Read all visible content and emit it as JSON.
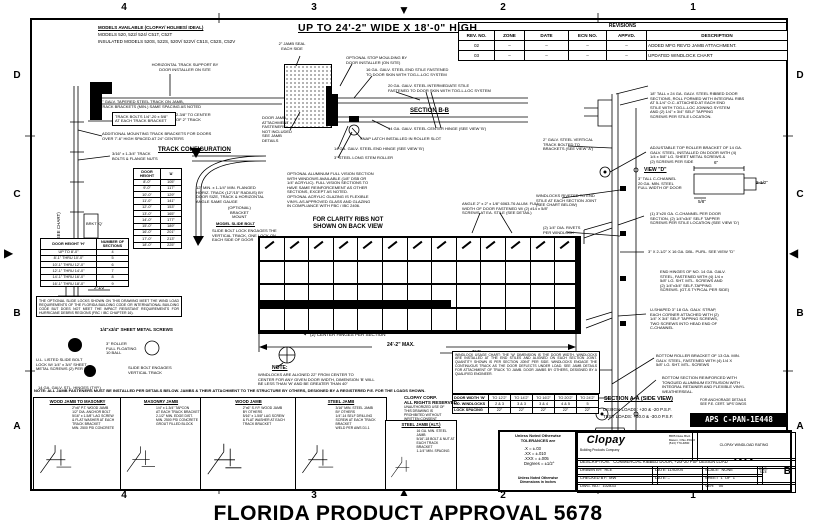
{
  "sheet": {
    "footer": "FLORIDA PRODUCT APPROVAL 5678",
    "grid_cols": [
      "4",
      "3",
      "2",
      "1"
    ],
    "grid_rows": [
      "D",
      "C",
      "B",
      "A"
    ]
  },
  "header": {
    "models_title": "MODELS AVAILABLE (CLOPAY/ HOLMES/ IDEAL)",
    "models_line1": "MODELS 520, 522/ 524/ C51T, C52T",
    "models_line2": "INSULATED MODELS 520S, 522S, 520V/ 522V/ C51S, C52S, C52V",
    "size_title": "UP TO 24'-2\" WIDE X 18'-0\" HIGH"
  },
  "revisions": {
    "title": "REVISIONS",
    "columns": [
      "REV. NO.",
      "ZONE",
      "DATE",
      "ECN NO.",
      "APPVD.",
      "DESCRIPTION"
    ],
    "rows": [
      [
        "02",
        "–",
        "–",
        "–",
        "–",
        "ADDED MFG REV'D JAMB ATTACHMENT."
      ],
      [
        "03",
        "–",
        "–",
        "–",
        "–",
        "UPDATED WINDLOCK CHART"
      ]
    ]
  },
  "left_view": {
    "support_note": "HORIZONTAL TRACK SUPPORT BY\nDOOR INSTALLER ON SITE",
    "track_note": "2\" GALV. TAPERED STEEL TRACK ON JAMB,\nTRACK BRACKETS (MIN.) SAME SPACING AS NOTED",
    "bolt_note": "TRACK BOLTS 1/4\"-20 x 5/8\"\nAT EACH TRACK BRACKET",
    "bracket_dim": "2-3/8\" TO CENTER\nOF 2\" TRACK",
    "mounting_note": "ADDITIONAL MOUNTING TRACK BRACKETS FOR DOORS\nOVER 7'-6\" HIGH SPACED AT 24\" CENTERS",
    "brkt_note": "3/16\" x 1-3/4\" TRACK\nBOLTS & FLANGE NUTS",
    "height_dim": "DOOR HEIGHT 'H'  (SEE CHART)",
    "base_dim": "2-1/2\""
  },
  "track_config": {
    "title": "TRACK CONFIGURATION",
    "columns": [
      "DOOR\nHEIGHT",
      "'A'"
    ],
    "rows": [
      [
        "8'-0\"",
        "105\""
      ],
      [
        "9'-0\"",
        "117\""
      ],
      [
        "10'-0\"",
        "129\""
      ],
      [
        "11'-0\"",
        "141\""
      ],
      [
        "12'-0\"",
        "153\""
      ],
      [
        "13'-0\"",
        "165\""
      ],
      [
        "14'-0\"",
        "177\""
      ],
      [
        "15'-0\"",
        "189\""
      ],
      [
        "16'-0\"",
        "201\""
      ],
      [
        "17'-0\"",
        "213\""
      ],
      [
        "18'-0\"",
        "225\""
      ]
    ],
    "radius_note": "12\" MIN. x 1-1/4\" MIN. FLANGED\nHORIZ. TRACK (12\"/15\" RADIUS) BY\nDOOR SIZE, TRACK & HORIZONTAL\nANGLE SAME GAUGE",
    "optional_note": "(OPTIONAL)\nBRACKET\nMOUNT",
    "slide_title": "MODEL SLIDE BOLT",
    "slide_note": "SLIDE BOLT LOCK ENGAGES THE\nVERTICAL TRACK, ONE LOCK ON\nEACH SIDE OF DOOR",
    "brkt_q": "BRKT 'Q'"
  },
  "sections_table": {
    "columns": [
      "DOOR HEIGHT 'H'",
      "NUMBER OF\nSECTIONS"
    ],
    "rows": [
      [
        "UP TO 8'-0\"",
        "4"
      ],
      [
        "8'-1\" THRU 10'-0\"",
        "5"
      ],
      [
        "10'-1\" THRU 12'-0\"",
        "6"
      ],
      [
        "12'-1\" THRU 14'-0\"",
        "7"
      ],
      [
        "14'-1\" THRU 16'-0\"",
        "8"
      ],
      [
        "16'-1\" THRU 18'-0\"",
        "9"
      ]
    ]
  },
  "code_note": "THE OPTIONAL SLIDE LOCKS SHOWN ON THIS DRAWING MEET THE WIND LOAD REQUIREMENTS OF THE FLORIDA BUILDING CODE OR INTERNATIONAL BUILDING CODE BUT DOES NOT MEET THE IMPACT RESISTANT REQUIREMENTS FOR HURRICANE DEBRIS REGIONS (FBC / IBC CHAPTER 16).",
  "hardware": {
    "screws_label": "1/4\"x3/4\" SHEET METAL SCREWS",
    "lock_note": "U.L. LISTED SLIDE BOLT\nLOCK W/ 1/4\" x 3/4\" SHEET\nMETAL SCREWS (2) PER LOCK",
    "roller_label": "3\" ROLLER\nFULL FLOATING\n10 BALL",
    "keeper_note": "SLIDE BOLT ENGAGES\nVERTICAL TRACK",
    "hinge_label": "14 GA. GALV. STL. HINGES (TYP.)"
  },
  "back_view": {
    "cols": 13,
    "rows": 4,
    "clarity_note": "FOR CLARITY RIBS NOT\nSHOWN ON BACK VIEW",
    "glazing_note": "OPTIONAL ALUMINUM FULL VISION SECTION\nWITH WINDOWS AVAILABLE (1/8\" DSB OR\n1/4\" ACRYLIC). FULL VISION SECTIONS TO\nHAVE SAME REINFORCEMENT AS OTHER\nSECTIONS, EXCEPT AS NOTED.\nOPTIONAL ACRYLIC GLAZING IS FLEXIBLE\nVINYL AS APPROVED GLASS AND GLAZING\nIN COMPLIANCE WITH FBC / IBC 2406.",
    "ubar_note": "ANGLE 2\" x 2\" x 1/8\" 6063-T6 ALUM. FULL\nWIDTH OF DOOR FASTENED W/ (2) #14 x 5/8\"\nSCREWS AT EA. STILE (SEE DETAIL)",
    "center_hinges": "(2) CENTER HINGES PER SECTION",
    "width_dim": "24'-2\" MAX.",
    "typ_label": "TYP.",
    "note_title": "NOTE:",
    "note_body": "WINDLOCKS ARE ALIGNED 22\" FROM CENTER TO\nCENTER FOR ANY GIVEN DOOR WIDTH, DIMENSION 'B' WILL\nBE LESS THAN 'W' AND BE GREATER THAN 40\""
  },
  "section_bb": {
    "jamb_seal": "2\" JAMB SEAL\nEACH SIDE",
    "stop_note": "OPTIONAL STOP MOULDING BY\nDOOR INSTALLER (ON SITE)",
    "end_stile": "16 GA. GALV. STEEL END STILE FASTENED\nTO DOOR SKIN WITH TOG-L-LOC SYSTEM",
    "int_stile": "20 GA. GALV. STEEL INTERMEDIATE STILE\nFASTENED TO DOOR SKIN WITH TOG-L-LOC SYSTEM",
    "label": "SECTION B-B",
    "center_hinge": "14 GA. GALV. STEEL CENTER HINGE (SEE VIEW 'B')",
    "snap_latch": "SNAP LATCH INSTALLED IN ROLLER SLOT",
    "end_hinge": "14 GA. GALV. STEEL END HINGE (SEE VIEW 'B')",
    "roller": "3\" STEEL LONG STEM ROLLER",
    "jamb_note": "DOOR JAMB\nATTACHMENT\nFASTENERS\nNOT INCLUDED\nSEE JAMB\nDETAILS"
  },
  "section_aa": {
    "sections_note": "18\" TALL x 24 GA. GALV. STEEL RIBBED DOOR\nSECTIONS, ROLL FORMED WITH INTEGRAL RIBS\nAT 5-1/4\" O.C. ATTACHED AT EACH END\nSTILE WITH TOG-L-LOC JOINING SYSTEM\nAND (2) 1/4\" x 3/4\" SELF TAPPING\nSCREWS PER STILE LOCATION.",
    "top_bracket": "ADJUSTABLE TOP ROLLER BRACKET OF 14 GA.\nGALV. STEEL, INSTALLED ON DOOR WITH (4)\n1/4 x 5/8\" LG. SHEET METAL SCREWS &\n(2) SCREWS PER SIDE",
    "view_d_label": "VIEW \"D\"",
    "view_d_sub": "3\" TALL C-CHANNEL\n20 GA. MIN. STEEL\nFULL WIDTH OF DOOR",
    "dim_w": "6\"",
    "dim_h": "2-1/2\"",
    "dim_t": "5/8\"",
    "channel_note": "(1) 3\"x20 GA. C-CHANNEL PER DOOR\nSECTION, (2) 1/4\"x3/4\" SELF TAPPER\nSCREWS PER STILE LOCATION (SEE VIEW 'D')",
    "purlin_note": "3\" X 2-1/2\" X 16 GA. DBL. PURL. SEE VIEW \"D\"",
    "end_hinge_note": "END HINGES OF NO. 14 GA. GALV.\nSTEEL, FASTENED WITH (4) 1/4 x\n5/8\" LG. SHT. MTL. SCREWS AND\n(2) 1/4\"x3/4\" SELF-TAPPING\nSCREWS. (GT-S TYPICAL PER SIDE)",
    "strap_note": "U-SHAPED 3\" 18 GA. GALV. STRAP,\nEACH CORNER ATTACHED WITH (2)\n1/4\" X 3/4\" SELF TAPPING SCREWS,\nTWO SCREWS INTO HEAD END OF\nC-CHANNEL",
    "bottom_bracket": "BOTTOM ROLLER BRACKET OF 13 GA. MIN.\nGALV. STEEL, FASTENED WITH (4) 1/4 X\n5/8\" LG. SHT. MTL. SCREWS",
    "bottom_seal": "BOTTOM SECTION REINFORCED WITH\nTONGUED ALUMINUM EXTRUSION WITH\nINTEGRAL RETAINER AND FLEXIBLE VINYL\nWEATHERSEAL.",
    "vert_track": "2\" GALV. STEEL VERTICAL\nTRACK BOLTED TO\nBRACKETS (SEE VIEW 'A')",
    "windlock_note": "WINDLOCKS RIVETED TO END\nSTILE AT EACH SECTION JOINT\n(SEE CHART BELOW)",
    "rivet_note": "(2) 1/4\" DIA. RIVETS\nPER WINDLOCK",
    "aa_label": "SECTION A-A (SIDE VIEW)",
    "design_loads": "DESIGN LOADS: +20 & -20 P.S.F.",
    "test_loads": "TEST LOADS: +30.0 & -30.0 P.S.F."
  },
  "windlock_chart": {
    "note": "WINDLOCK USAGE CHART: THE 'W' DIMENSION IS THE DOOR WIDTH. WINDLOCKS ARE INSTALLED AT THE END STILES AND ALIGNED ON EACH SECTION JOINT. QUANTITY SHOWN IS PER SECTION JOINT PER SIDE. WINDLOCKS ENGAGE THE CONTINUOUS TRACK AS THE DOOR DEFLECTS UNDER LOAD. SEE JAMB DETAILS FOR ATTACHMENT OF TRACK TO JAMB. DOOR JAMBS BY OTHERS, DESIGNED BY A QUALIFIED ENGINEER.",
    "rows": [
      [
        "DOOR WIDTH 'W'",
        "TO 12'2\"",
        "TO 14'2\"",
        "TO 16'2\"",
        "TO 20'2\"",
        "TO 24'2\""
      ],
      [
        "NO. WINDLOCKS",
        "2 & 3",
        "3 & 3",
        "3 & 4",
        "4 & 5",
        "5"
      ],
      [
        "LOCK SPACING",
        "22\"",
        "22\"",
        "22\"",
        "22\"",
        "22\""
      ]
    ]
  },
  "aps": {
    "anchors_note": "FOR ANCHORAGE DETAILS\nSEE P.E. CERT. 'APS' DWGS",
    "code": "APS C-PAN-1E448"
  },
  "details": {
    "note": "NOTE: ALL JAMB FASTENERS MUST BE INSTALLED PER DETAILS BELOW. JAMBS & THEIR ATTACHMENT TO THE STRUCTURE BY OTHERS, DESIGNED BY A REGISTERED P.E. FOR THE LOADS SHOWN.",
    "panels": [
      {
        "title": "WOOD JAMB TO MASONRY",
        "lines": "2\"x6\" P.T. WOOD JAMB\n1/2\" DIA. ANCHOR BOLT\n5/16\" x 1-5/8\" LAG SCREW\n& FLAT WASHER AT EACH\nTRACK BRACKET\nMIN. 2500 PSI CONCRETE"
      },
      {
        "title": "MASONRY JAMB",
        "lines": "1/4\" x 1-3/4\" TAPCON\nAT EACH TRACK BRACKET\n2-1/2\" MIN. EDGE DIST.\nMIN. 2500 PSI CONCRETE\nGROUT FILLED BLOCK"
      },
      {
        "title": "WOOD JAMB",
        "lines": "2\"x6\" S.Y.P. WOOD JAMB\nBY OTHERS\n5/16\" x 1-5/8\" LAG SCREW\n& FLAT WASHER AT EACH\nTRACK BRACKET"
      },
      {
        "title": "STEEL JAMB",
        "lines": "3/16\" MIN. STEEL JAMB\nBY OTHERS\n1/4\"-14 SELF DRILLING\nSCREW AT EACH TRACK\nBRACKET\nWELD PER AWS D1.1"
      },
      {
        "title": "STEEL JAMB (ALT.)",
        "lines": "16 GA. MIN. STEEL JAMB\n5/16\"-18 BOLT & NUT AT\nEACH TRACK BRACKET\n1-1/4\" MIN. SPACING"
      }
    ]
  },
  "copyright": {
    "main": "CLOPAY CORP.\nALL RIGHTS RESERVED.",
    "sub": "UNAUTHORIZED USE OF\nTHIS DRAWING IS\nPROHIBITED WITHOUT\nWRITTEN CONSENT"
  },
  "tolerances": {
    "title": "Unless Noted Otherwise\nTOLERANCES are",
    "lines": ".X = ±.03\n.XX = ±.010\n.XXX = ±.005\nDegrees = ±1/2°",
    "footer": "Unless Noted Otherwise\nDimensions in Inches"
  },
  "title_block": {
    "logo": "Clopay",
    "logo_sub": "Building Products Company",
    "addr": "8585 Duke Blvd.\nMason, Ohio 45040\n(513) 770-4800",
    "windload_label": "CLOPAY WINDLOAD RATING",
    "windload_value": "W4",
    "description": "DESCRIPTION:   COMMERCIAL RIBBED DOOR, +20/-20 PSF DESIGN LOAD",
    "drawn_by": "DRAWN BY:  RLE",
    "drawn_date": "DATE: 11/02/04",
    "scale": "SCALE:  NONE",
    "size_label": "DWG.\nSIZE",
    "size_value": "B",
    "checked_by": "CHECKED BY:  MW",
    "checked_date": "DATE: –",
    "sheet": "SHEET  1  OF  1",
    "dwg_no": "DWG. NO.:  102833",
    "ver": "VER:    00"
  }
}
